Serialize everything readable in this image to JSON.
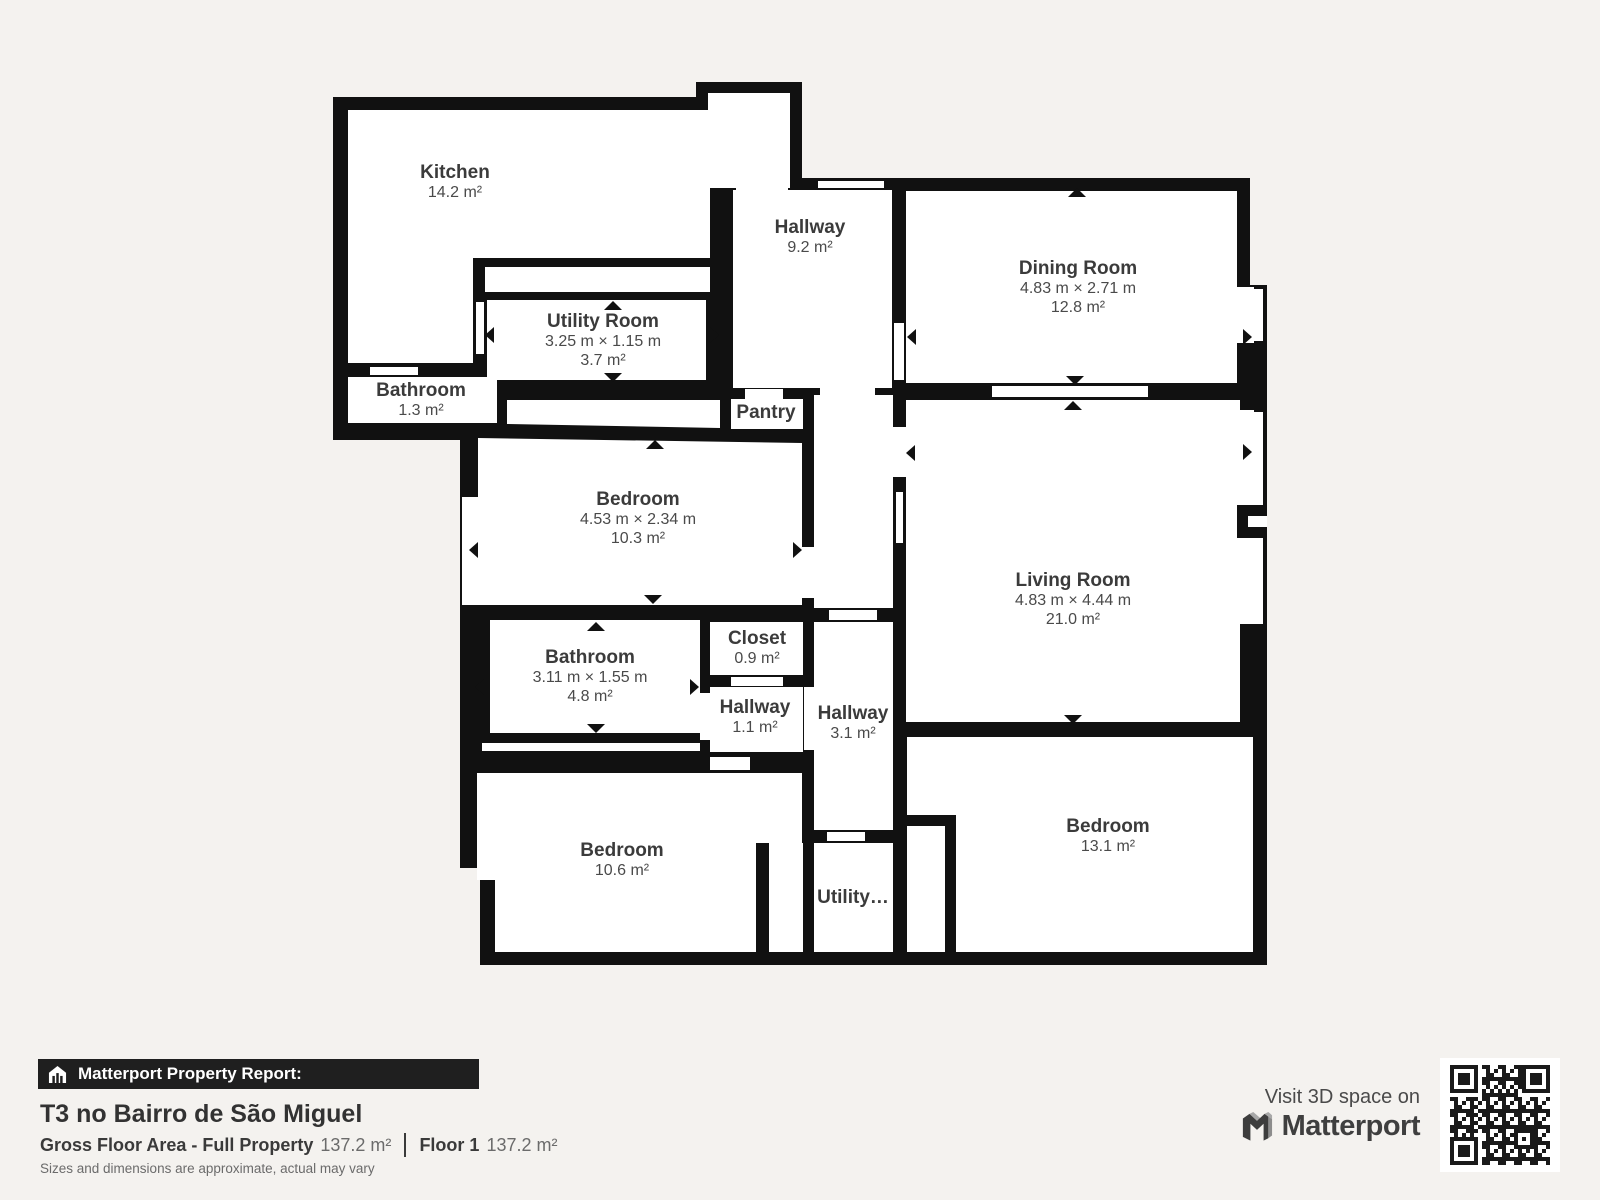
{
  "plan": {
    "rooms": [
      {
        "id": "kitchen",
        "name": "Kitchen",
        "area": "14.2 m²"
      },
      {
        "id": "hallway-main",
        "name": "Hallway",
        "area": "9.2 m²"
      },
      {
        "id": "dining-room",
        "name": "Dining Room",
        "dims": "4.83 m × 2.71 m",
        "area": "12.8 m²"
      },
      {
        "id": "utility-room",
        "name": "Utility Room",
        "dims": "3.25 m × 1.15 m",
        "area": "3.7 m²"
      },
      {
        "id": "bathroom-small",
        "name": "Bathroom",
        "area": "1.3 m²"
      },
      {
        "id": "pantry",
        "name": "Pantry"
      },
      {
        "id": "bedroom-1",
        "name": "Bedroom",
        "dims": "4.53 m × 2.34 m",
        "area": "10.3 m²"
      },
      {
        "id": "living-room",
        "name": "Living Room",
        "dims": "4.83 m × 4.44 m",
        "area": "21.0 m²"
      },
      {
        "id": "closet",
        "name": "Closet",
        "area": "0.9 m²"
      },
      {
        "id": "bathroom-main",
        "name": "Bathroom",
        "dims": "3.11 m × 1.55 m",
        "area": "4.8 m²"
      },
      {
        "id": "hallway-small",
        "name": "Hallway",
        "area": "1.1 m²"
      },
      {
        "id": "hallway-lower",
        "name": "Hallway",
        "area": "3.1 m²"
      },
      {
        "id": "bedroom-2",
        "name": "Bedroom",
        "area": "10.6 m²"
      },
      {
        "id": "bedroom-3",
        "name": "Bedroom",
        "area": "13.1 m²"
      },
      {
        "id": "utility-small",
        "name": "Utility…"
      }
    ]
  },
  "footer": {
    "report_label": "Matterport Property Report:",
    "property_title": "T3 no Bairro de São Miguel",
    "gross_label": "Gross Floor Area - Full Property",
    "gross_value": "137.2 m²",
    "floor_label": "Floor 1",
    "floor_value": "137.2 m²",
    "disclaimer": "Sizes and dimensions are approximate, actual may vary"
  },
  "cta": {
    "visit_text": "Visit 3D space on",
    "brand": "Matterport"
  },
  "colors": {
    "background": "#f4f2ef",
    "wall": "#111111",
    "room_fill": "#ffffff",
    "label_text": "#3b3b3b",
    "bar_background": "#1f1f1f",
    "qr_dark": "#1a1a1a"
  }
}
